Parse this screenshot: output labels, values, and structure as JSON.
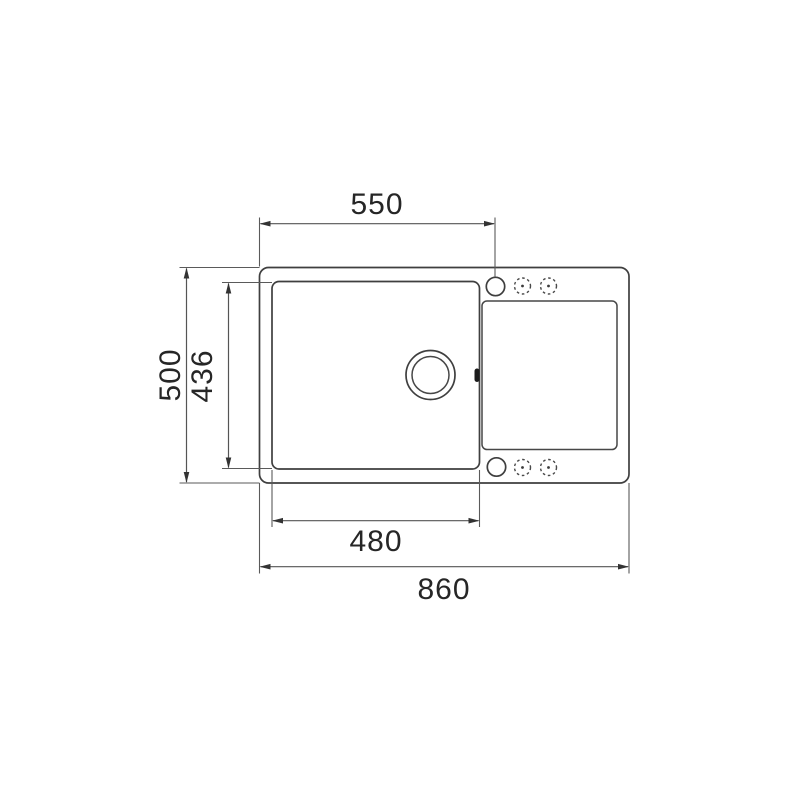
{
  "page": {
    "background_color": "#ffffff",
    "line_color": "#3f3f3f",
    "dimension_line_color": "#555555",
    "text_color": "#262626"
  },
  "drawing": {
    "subject": "kitchen sink top view technical drawing with one bowl, drainer board, drain hole and tap holes",
    "dimension_labels": {
      "tap_hole_offset": "550",
      "overall_depth": "500",
      "bowl_depth": "436",
      "bowl_width": "480",
      "overall_width": "860"
    }
  }
}
